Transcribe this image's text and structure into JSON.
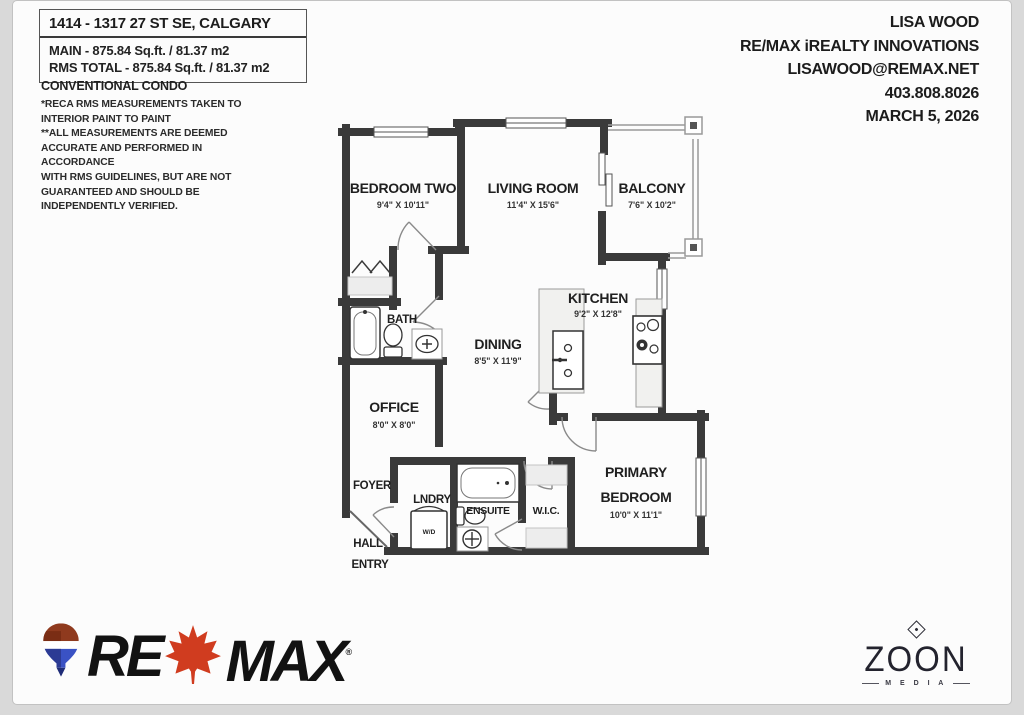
{
  "info_box": {
    "address": "1414 - 1317 27 ST SE, CALGARY",
    "main_area": "MAIN - 875.84 Sq.ft. / 81.37 m2",
    "rms_total": "RMS TOTAL - 875.84 Sq.ft. / 81.37 m2"
  },
  "property_type": "CONVENTIONAL CONDO",
  "disclaimer": [
    "*RECA RMS MEASUREMENTS TAKEN TO",
    "INTERIOR PAINT TO PAINT",
    "**ALL MEASUREMENTS ARE DEEMED",
    "ACCURATE AND PERFORMED IN ACCORDANCE",
    "WITH RMS GUIDELINES, BUT ARE NOT",
    "GUARANTEED AND SHOULD BE",
    "INDEPENDENTLY VERIFIED."
  ],
  "agent": {
    "name": "LISA WOOD",
    "brokerage": "RE/MAX iREALTY INNOVATIONS",
    "email": "LISAWOOD@REMAX.NET",
    "phone": "403.808.8026",
    "date": "MARCH 5, 2026"
  },
  "plan": {
    "rooms": {
      "bedroom_two": {
        "name": "BEDROOM TWO",
        "dims": "9'4\" X 10'11\""
      },
      "living_room": {
        "name": "LIVING ROOM",
        "dims": "11'4\" X 15'6\""
      },
      "balcony": {
        "name": "BALCONY",
        "dims": "7'6\" X 10'2\""
      },
      "kitchen": {
        "name": "KITCHEN",
        "dims": "9'2\" X 12'8\""
      },
      "dining": {
        "name": "DINING",
        "dims": "8'5\" X 11'9\""
      },
      "bath": {
        "name": "BATH"
      },
      "office": {
        "name": "OFFICE",
        "dims": "8'0\" X 8'0\""
      },
      "foyer": {
        "name": "FOYER"
      },
      "laundry": {
        "name": "LNDRY",
        "appliance": "W/D"
      },
      "ensuite": {
        "name": "ENSUITE"
      },
      "wic": {
        "name": "W.I.C."
      },
      "primary": {
        "line1": "PRIMARY",
        "line2": "BEDROOM",
        "dims": "10'0\" X 11'1\""
      },
      "hall_entry": {
        "line1": "HALL",
        "line2": "ENTRY"
      }
    }
  },
  "logos": {
    "remax": {
      "re": "RE",
      "max": "MAX",
      "mark": "®"
    },
    "zoon": {
      "name": "ZOON",
      "sub": "M E D I A"
    }
  },
  "colors": {
    "wall": "#3a3a3a",
    "leaf_red": "#d03c1f",
    "balloon_red": "#8f3a1e",
    "balloon_blue": "#2c3b94",
    "logo_black": "#121212",
    "zoon_dark": "#23232e"
  }
}
